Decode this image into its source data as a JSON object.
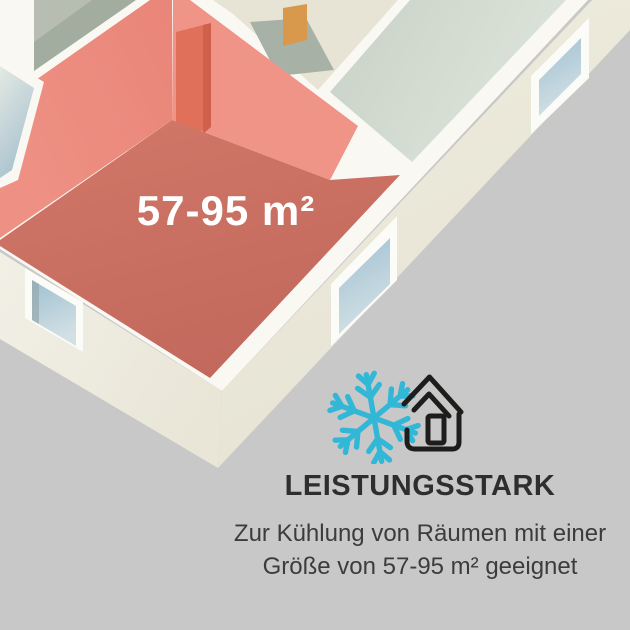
{
  "floorplan": {
    "area_label": "57-95 m²",
    "highlighted_room": "red highlighted corner room",
    "elements": [
      "room-floors",
      "interior-walls",
      "door-opening",
      "windows"
    ]
  },
  "feature": {
    "heading": "LEISTUNGSSTARK",
    "description_line1": "Zur Kühlung von Räumen mit einer",
    "description_line2": "Größe von 57-95 m² geeignet"
  },
  "icons": [
    {
      "name": "snowflake-icon",
      "color": "#33b7d6"
    },
    {
      "name": "house-icon",
      "color": "#1d1d1b"
    }
  ],
  "colors": {
    "background": "#c8c8c8",
    "accent_cyan": "#33b7d6",
    "icon_dark": "#1d1d1b",
    "heading_text": "#2e2e2e",
    "body_text": "#3c3c3c",
    "label_text": "#ffffff",
    "room_wall_red": "#ec8d80",
    "room_floor_red": "#c76c60",
    "door_red": "#e0705a",
    "wall_white": "#f9f8f3",
    "exterior_cream": "#ebe8da",
    "floor_sage": "#a2ac9f",
    "floor_mint": "#d3dcd1",
    "floor_cream": "#e7e4d6",
    "window_glass": "#a3c4d6"
  }
}
